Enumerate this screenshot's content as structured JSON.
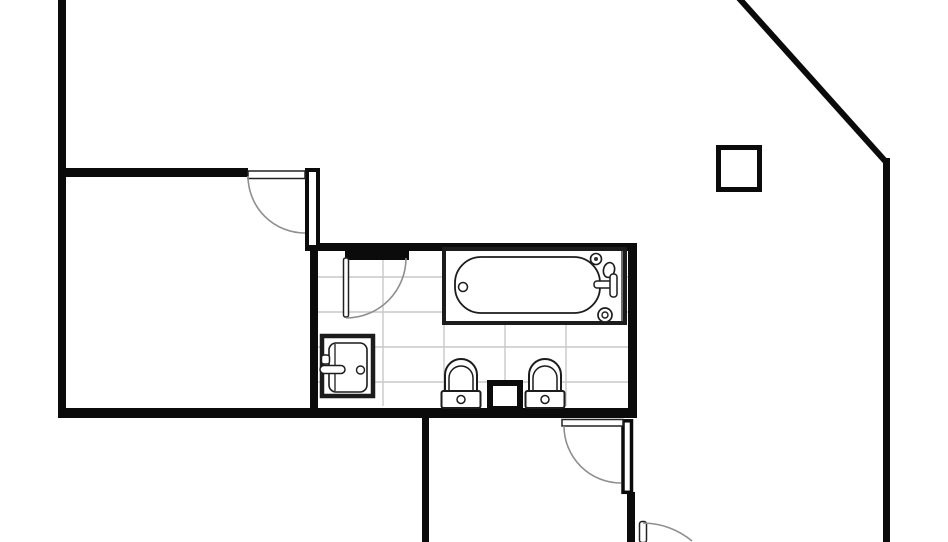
{
  "canvas": {
    "width_px": 948,
    "height_px": 542,
    "kind": "architectural floor plan, black line drawing on white, cropped at top and bottom edges"
  },
  "colors": {
    "background": "#ffffff",
    "wall": "#0b0b0b",
    "fixture": "#1c1c1c",
    "arc": "#8f8f8f",
    "tile": "#c9c9c9"
  },
  "glyphs": [
    "exterior-wall-left",
    "exterior-wall-diagonal",
    "exterior-wall-right",
    "room-divider-wall",
    "bathroom-walls",
    "swing-door-upper-left",
    "swing-door-bathroom",
    "swing-door-lower-room",
    "swing-door-bottom-right",
    "wall-stub-hollow-upper",
    "wall-stub-hollow-lower",
    "square-column",
    "tiled-bathroom-floor",
    "bathtub-with-faucet",
    "vanity-sink",
    "toilet-left",
    "toilet-right",
    "recessed-box-between-toilets"
  ]
}
